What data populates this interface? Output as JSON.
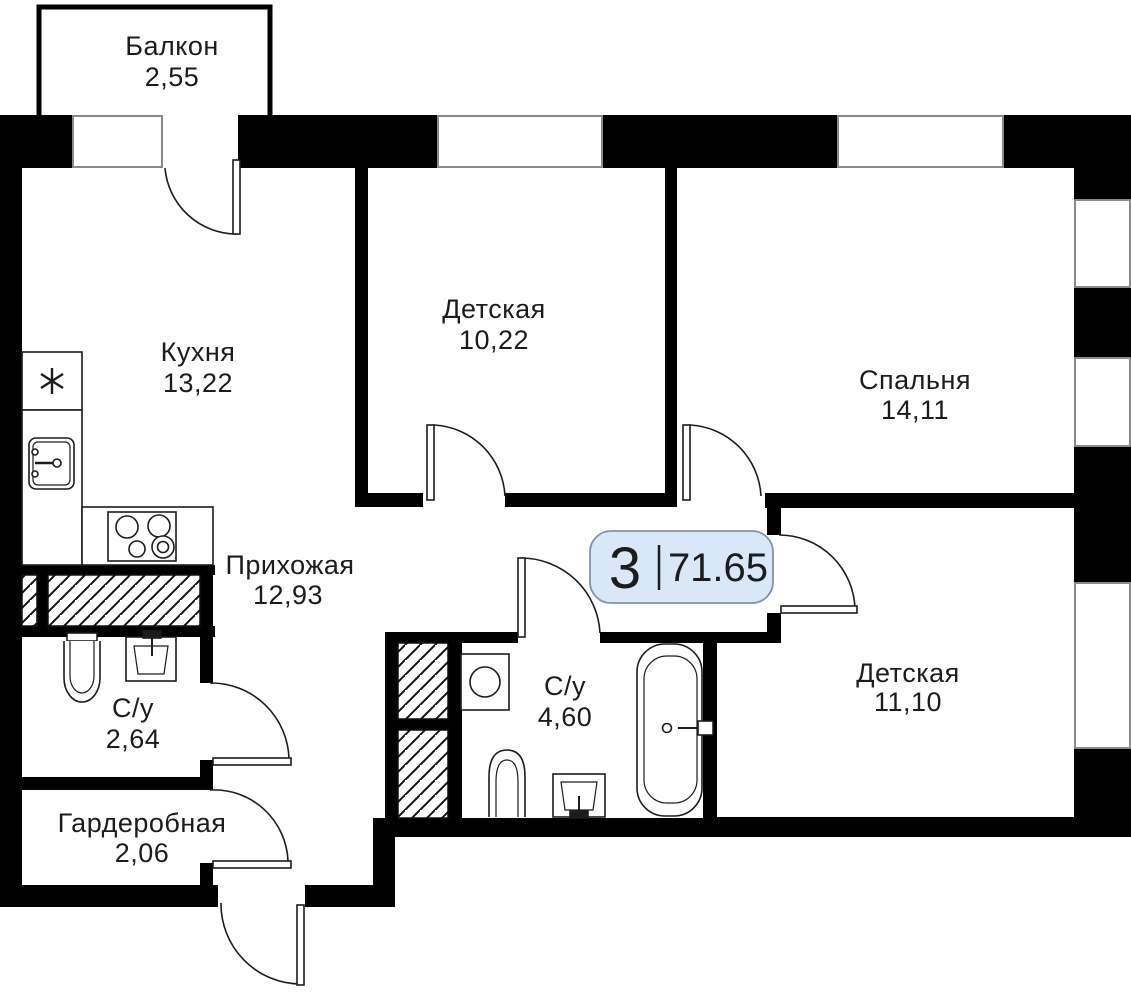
{
  "plan": {
    "badge": {
      "rooms_count": "3",
      "total_area": "71.65"
    },
    "rooms": [
      {
        "name": "Балкон",
        "area": "2,55"
      },
      {
        "name": "Кухня",
        "area": "13,22"
      },
      {
        "name": "Детская",
        "area": "10,22"
      },
      {
        "name": "Спальня",
        "area": "14,11"
      },
      {
        "name": "Прихожая",
        "area": "12,93"
      },
      {
        "name": "С/у",
        "area": "2,64"
      },
      {
        "name": "С/у",
        "area": "4,60"
      },
      {
        "name": "Детская",
        "area": "11,10"
      },
      {
        "name": "Гардеробная",
        "area": "2,06"
      }
    ],
    "colors": {
      "wall": "#000000",
      "line": "#1c1c1c",
      "window_border": "#8a8a8a",
      "badge_fill": "#d9e8f8",
      "badge_border": "#7d93ad"
    }
  }
}
